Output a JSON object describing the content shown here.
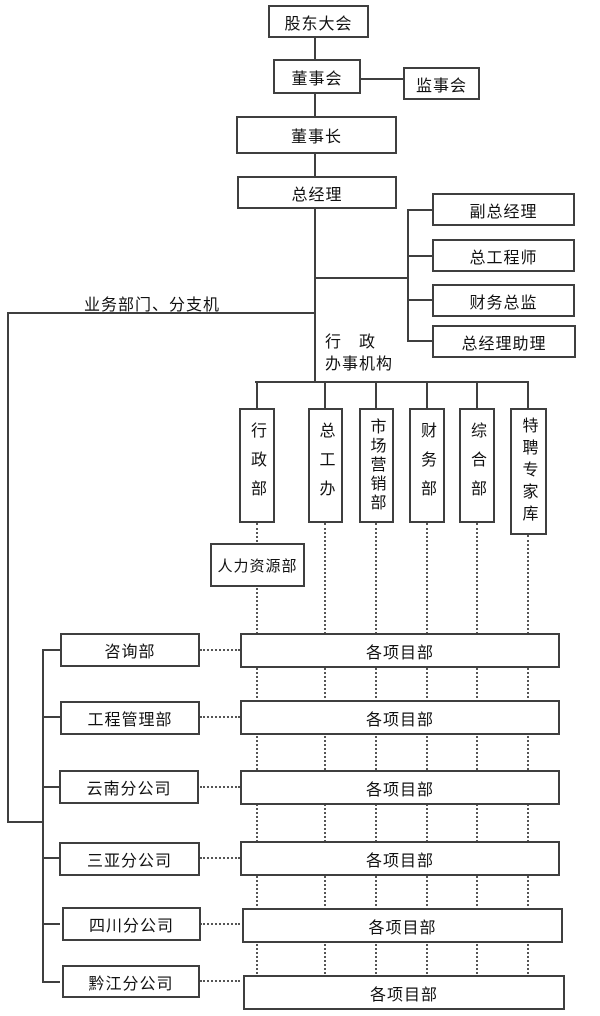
{
  "colors": {
    "background": "#ffffff",
    "line": "#3f3f3f",
    "text": "#111111"
  },
  "chart": {
    "nodes": {
      "shareholders_meeting": "股东大会",
      "board_of_directors": "董事会",
      "supervisory_board": "监事会",
      "chairman": "董事长",
      "general_manager": "总经理"
    },
    "executives": [
      "副总经理",
      "总工程师",
      "财务总监",
      "总经理助理"
    ],
    "business_branch_label": "业务部门、分支机",
    "admin_office_label": {
      "line1": "行　政",
      "line2": "办事机构"
    },
    "admin_departments": [
      "行政部",
      "总工办",
      "市场营销部",
      "财务部",
      "综合部",
      "特聘专家库"
    ],
    "hr_department": "人力资源部",
    "business_units": [
      "咨询部",
      "工程管理部",
      "云南分公司",
      "三亚分公司",
      "四川分公司",
      "黔江分公司"
    ],
    "project_departments": [
      "各项目部",
      "各项目部",
      "各项目部",
      "各项目部",
      "各项目部",
      "各项目部"
    ]
  }
}
